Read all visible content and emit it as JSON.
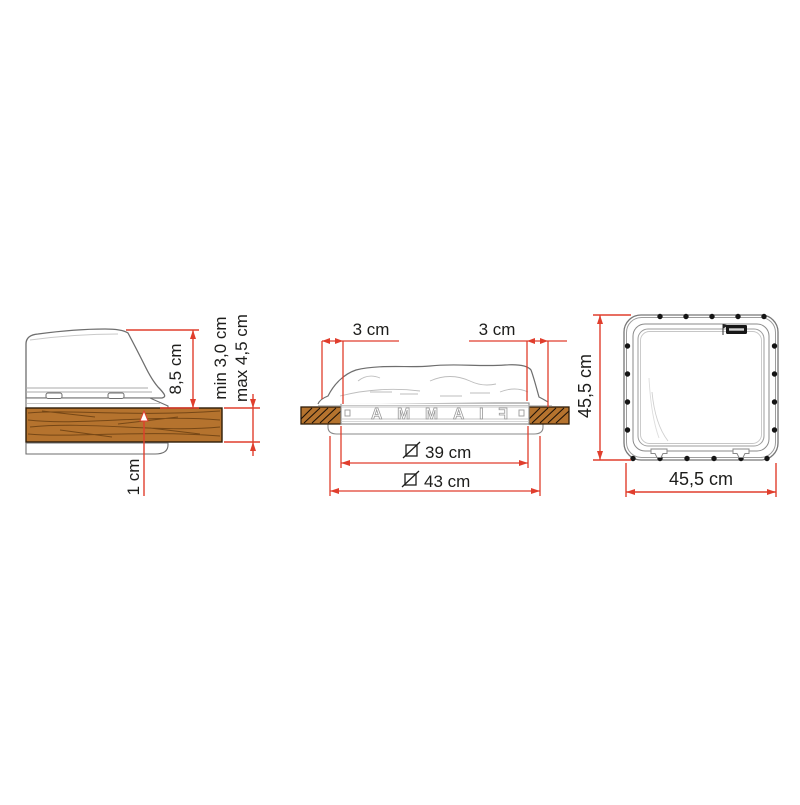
{
  "page": {
    "background": "#ffffff"
  },
  "colors": {
    "dimension_red": "#e03e2d",
    "text": "#1d1d1b",
    "outline_gray": "#6e6e6e",
    "light_gray": "#a8a8a8",
    "wood_fill": "#b5732e",
    "wood_edge": "#2e1c08",
    "wood_grain": "#6b3f12",
    "badge_black": "#161616"
  },
  "views": {
    "side_section": {
      "dome_height": "8,5 cm",
      "roof_min": "min 3,0 cm",
      "roof_max": "max 4,5 cm",
      "inner_frame_depth": "1 cm"
    },
    "front_section": {
      "flange_left": "3 cm",
      "flange_right": "3 cm",
      "cutout_inner": "39 cm",
      "cutout_outer": "43 cm",
      "cutout_symbol_icon": "slashed-square-icon",
      "molded_text": "FIAMMA"
    },
    "frame_view": {
      "height": "45,5 cm",
      "width": "45,5 cm",
      "badge_icon": "fiamma-logo-badge"
    }
  }
}
